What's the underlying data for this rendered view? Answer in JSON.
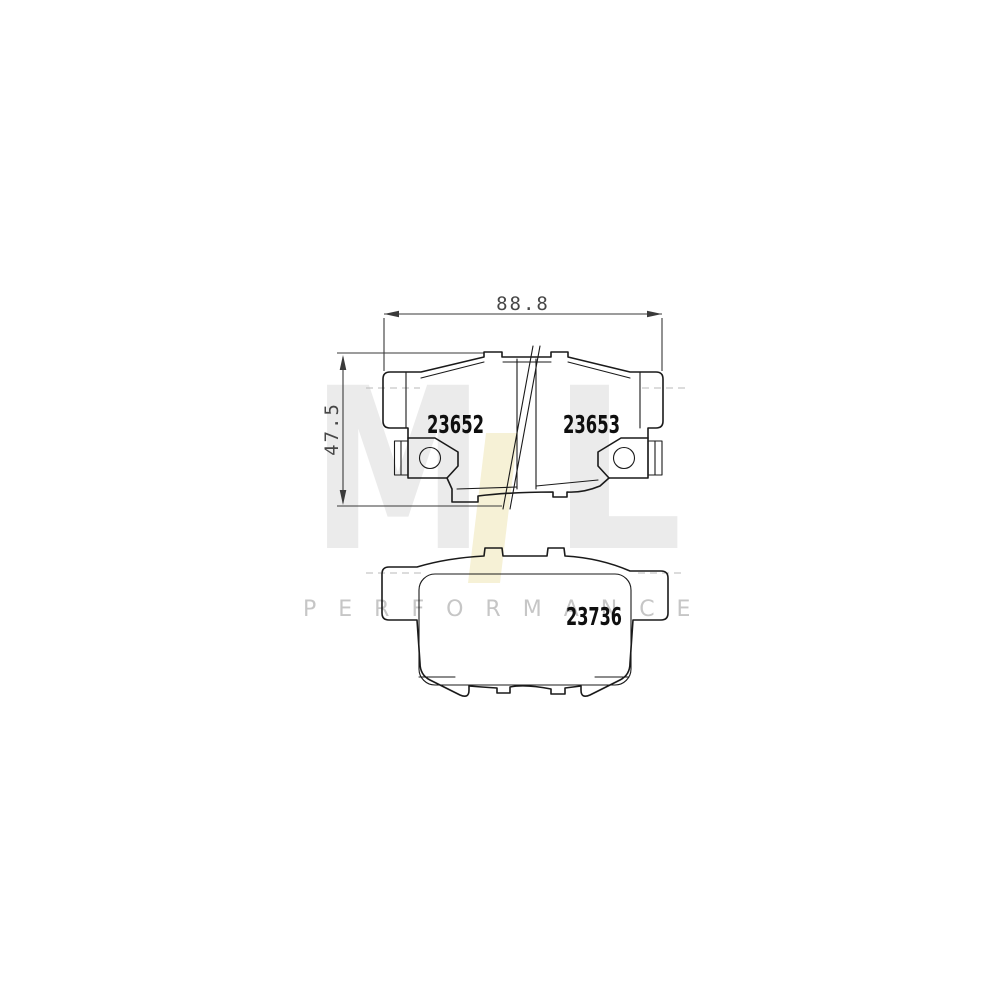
{
  "dimensions": {
    "width_label": "88.8",
    "height_label": "47.5"
  },
  "parts": {
    "pad_top_left_number": "23652",
    "pad_top_right_number": "23653",
    "pad_bottom_number": "23736"
  },
  "watermark": {
    "letter_m": "M",
    "letter_l": "L",
    "subtitle": "PERFORMANCE",
    "gray": "#ebebeb",
    "accent_yellow": "#f6f1d6",
    "subtitle_color": "#c6c6c6"
  },
  "colors": {
    "background": "#ffffff",
    "drawing_line": "#1a1a1a",
    "dimension_line": "#3a3a3a",
    "dimension_text": "#474747"
  }
}
